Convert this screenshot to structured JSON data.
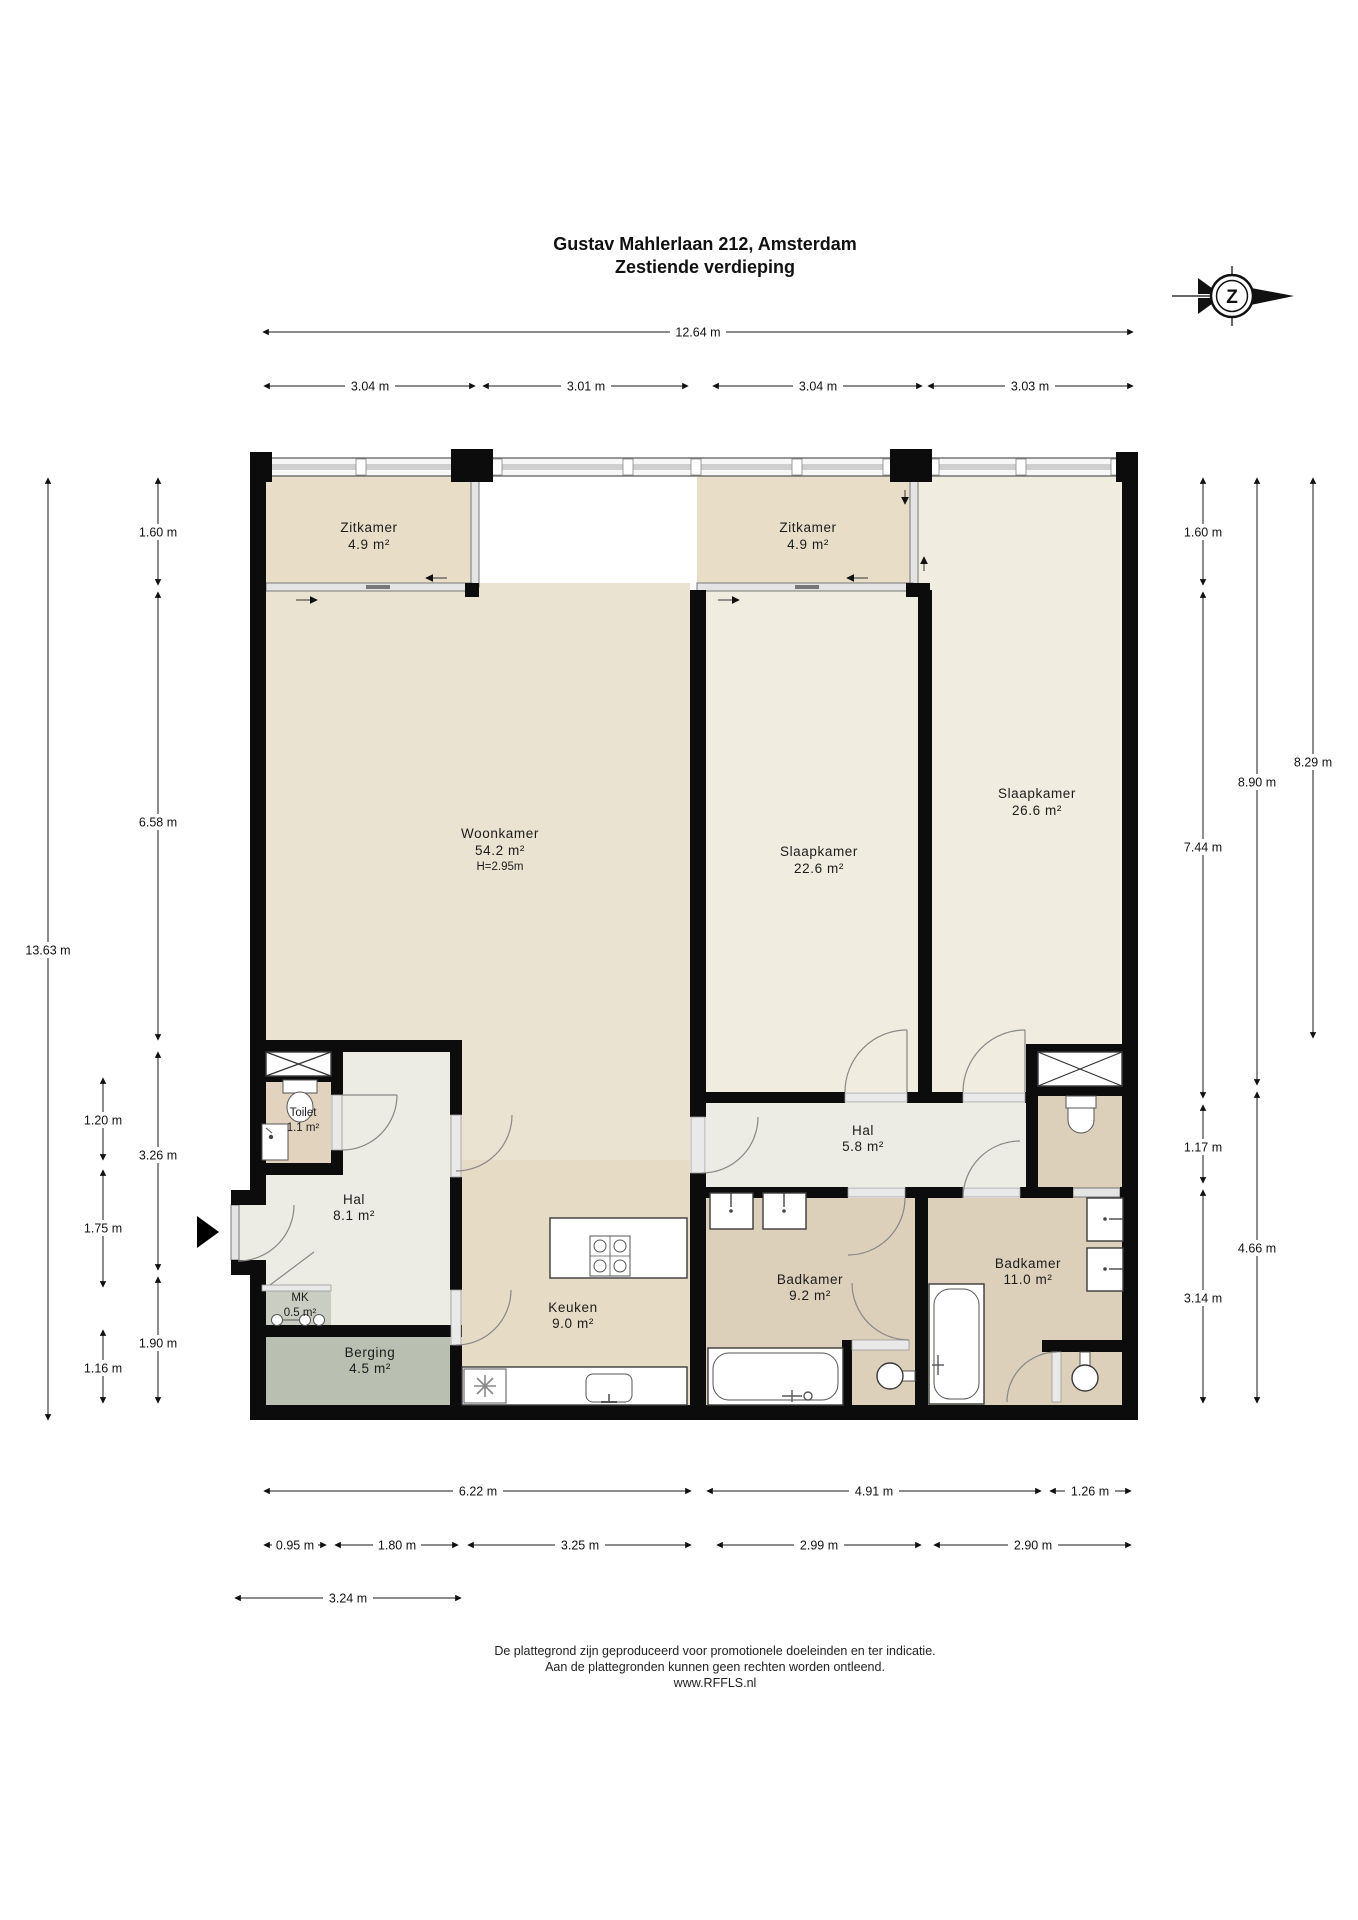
{
  "title": {
    "line1": "Gustav Mahlerlaan 212, Amsterdam",
    "line2": "Zestiende verdieping"
  },
  "compass": {
    "label": "Z"
  },
  "rooms": {
    "zitkamer1": {
      "name": "Zitkamer",
      "area": "4.9 m²"
    },
    "zitkamer2": {
      "name": "Zitkamer",
      "area": "4.9 m²"
    },
    "woonkamer": {
      "name": "Woonkamer",
      "area": "54.2 m²",
      "height": "H=2.95m"
    },
    "slaapkamer1": {
      "name": "Slaapkamer",
      "area": "22.6 m²"
    },
    "slaapkamer2": {
      "name": "Slaapkamer",
      "area": "26.6 m²"
    },
    "hal1": {
      "name": "Hal",
      "area": "8.1 m²"
    },
    "hal2": {
      "name": "Hal",
      "area": "5.8 m²"
    },
    "toilet": {
      "name": "Toilet",
      "area": "1.1 m²"
    },
    "mk": {
      "name": "MK",
      "area": "0.5 m²"
    },
    "berging": {
      "name": "Berging",
      "area": "4.5 m²"
    },
    "keuken": {
      "name": "Keuken",
      "area": "9.0 m²"
    },
    "badkamer1": {
      "name": "Badkamer",
      "area": "9.2 m²"
    },
    "badkamer2": {
      "name": "Badkamer",
      "area": "11.0 m²"
    }
  },
  "dimensions": {
    "top": {
      "total": "12.64 m",
      "segments": [
        "3.04 m",
        "3.01 m",
        "3.04 m",
        "3.03 m"
      ]
    },
    "left": {
      "total": "13.63 m",
      "col2": [
        "1.60 m",
        "6.58 m",
        "3.26 m",
        "1.90 m"
      ],
      "col3": [
        "1.20 m",
        "1.75 m",
        "1.16 m"
      ]
    },
    "right": {
      "col1": [
        "1.60 m",
        "7.44 m",
        "1.17 m",
        "3.14 m"
      ],
      "col2": [
        "8.90 m",
        "4.66 m"
      ],
      "col3": [
        "8.29 m"
      ]
    },
    "bottom": {
      "row1": [
        "6.22 m",
        "4.91 m",
        "1.26 m"
      ],
      "row2": [
        "0.95 m",
        "1.80 m",
        "3.25 m",
        "2.99 m",
        "2.90 m"
      ],
      "row3": [
        "3.24 m"
      ]
    }
  },
  "footer": {
    "line1": "De plattegrond zijn geproduceerd voor promotionele doeleinden en ter indicatie.",
    "line2": "Aan de plattegronden kunnen geen rechten worden ontleend.",
    "line3": "www.RFFLS.nl"
  }
}
